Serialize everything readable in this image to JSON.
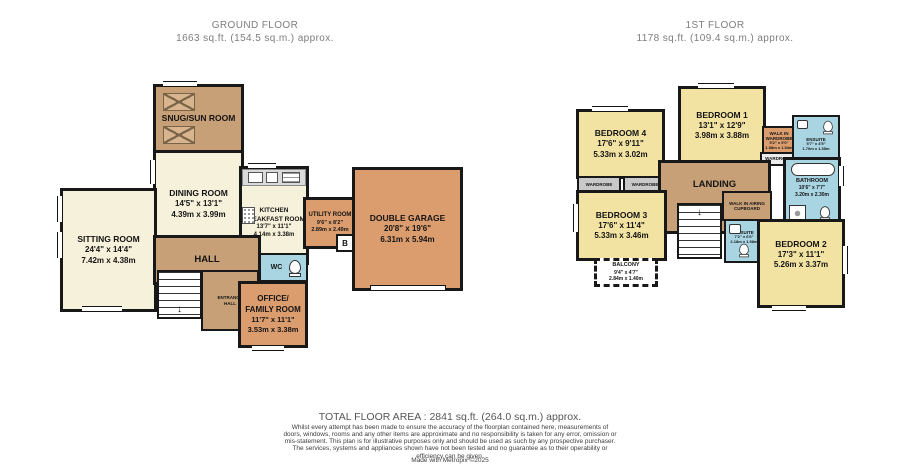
{
  "ground_floor": {
    "title": "GROUND FLOOR",
    "area": "1663 sq.ft. (154.5 sq.m.) approx.",
    "rooms": {
      "snug": {
        "name": "SNUG/SUN ROOM"
      },
      "dining": {
        "name": "DINING ROOM",
        "imperial": "14'5\" x 13'1\"",
        "metric": "4.39m x 3.99m"
      },
      "sitting": {
        "name": "SITTING ROOM",
        "imperial": "24'4\" x 14'4\"",
        "metric": "7.42m x 4.38m"
      },
      "kitchen": {
        "name": "KITCHEN BREAKFAST ROOM",
        "imperial": "13'7\" x 11'1\"",
        "metric": "4.14m x 3.38m"
      },
      "utility": {
        "name": "UTILITY ROOM",
        "imperial": "9'6\" x 8'2\"",
        "metric": "2.89m x 2.49m"
      },
      "garage": {
        "name": "DOUBLE GARAGE",
        "imperial": "20'8\" x 19'6\"",
        "metric": "6.31m x 5.94m"
      },
      "hall": {
        "name": "HALL"
      },
      "entrance": {
        "name": "ENTRANCE HALL"
      },
      "wc": {
        "name": "WC"
      },
      "office": {
        "name": "OFFICE/ FAMILY ROOM",
        "imperial": "11'7\" x 11'1\"",
        "metric": "3.53m x 3.38m"
      },
      "boiler": "B"
    }
  },
  "first_floor": {
    "title": "1ST FLOOR",
    "area": "1178 sq.ft. (109.4 sq.m.) approx.",
    "rooms": {
      "bedroom1": {
        "name": "BEDROOM 1",
        "imperial": "13'1\" x 12'9\"",
        "metric": "3.98m x 3.88m"
      },
      "bedroom2": {
        "name": "BEDROOM 2",
        "imperial": "17'3\" x 11'1\"",
        "metric": "5.26m x 3.37m"
      },
      "bedroom3": {
        "name": "BEDROOM 3",
        "imperial": "17'6\" x 11'4\"",
        "metric": "5.33m x 3.46m"
      },
      "bedroom4": {
        "name": "BEDROOM 4",
        "imperial": "17'6\" x 9'11\"",
        "metric": "5.33m x 3.02m"
      },
      "landing": {
        "name": "LANDING"
      },
      "bathroom": {
        "name": "BATHROOM",
        "imperial": "10'6\" x 7'7\"",
        "metric": "3.20m x 2.30m"
      },
      "ensuite1": {
        "name": "ENSUITE",
        "imperial": "5'7\" x 4'5\"",
        "metric": "1.70m x 1.35m"
      },
      "ensuite2": {
        "name": "ENSUITE",
        "imperial": "7'2\" x 6'6\"",
        "metric": "2.18m x 1.98m"
      },
      "walkin_wardrobe": {
        "name": "WALK IN WARDROBE",
        "imperial": "5'2\" x 5'0\"",
        "metric": "1.58m x 1.54m"
      },
      "airing": {
        "name": "WALK IN AIRING CUPBOARD"
      },
      "wardrobe": "WARDROBE",
      "balcony": {
        "name": "BALCONY",
        "imperial": "9'4\" x 4'7\"",
        "metric": "2.84m x 1.40m"
      }
    }
  },
  "icons": {
    "stairs_down_arrow": "↓"
  },
  "colors": {
    "cream": "#f6f1da",
    "brown": "#c7a077",
    "orange": "#dc9d6e",
    "yellow": "#f2e3a3",
    "blue": "#a9d4e2",
    "wall": "#181818"
  },
  "footer": {
    "total": "TOTAL FLOOR AREA : 2841 sq.ft. (264.0 sq.m.) approx.",
    "disclaimer": "Whilst every attempt has been made to ensure the accuracy of the floorplan contained here, measurements of doors, windows, rooms and any other items are approximate and no responsibility is taken for any error, omission or mis-statement. This plan is for illustrative purposes only and should be used as such by any prospective purchaser. The services, systems and appliances shown have not been tested and no guarantee as to their operability or efficiency can be given.",
    "credit": "Made with Metropix ©2025"
  }
}
